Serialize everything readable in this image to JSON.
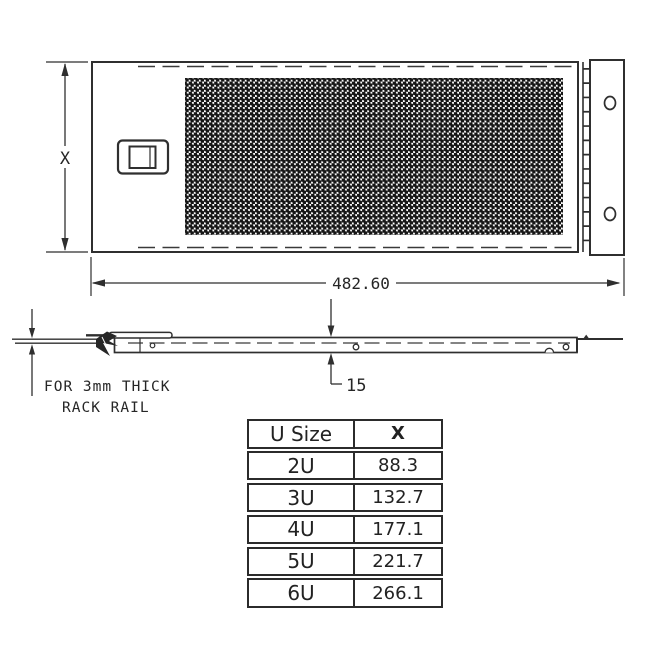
{
  "drawing": {
    "height_label": "X",
    "width_dim": "482.60",
    "thickness_dim": "15",
    "note_line1": "FOR 3mm THICK",
    "note_line2": "RACK RAIL"
  },
  "table": {
    "header": {
      "u_size": "U Size",
      "x": "X"
    },
    "rows": [
      {
        "u": "2U",
        "x": "88.3"
      },
      {
        "u": "3U",
        "x": "132.7"
      },
      {
        "u": "4U",
        "x": "177.1"
      },
      {
        "u": "5U",
        "x": "221.7"
      },
      {
        "u": "6U",
        "x": "266.1"
      }
    ]
  },
  "colors": {
    "line": "#2f2f2f",
    "background": "#ffffff",
    "mesh_dot": "#161616"
  }
}
